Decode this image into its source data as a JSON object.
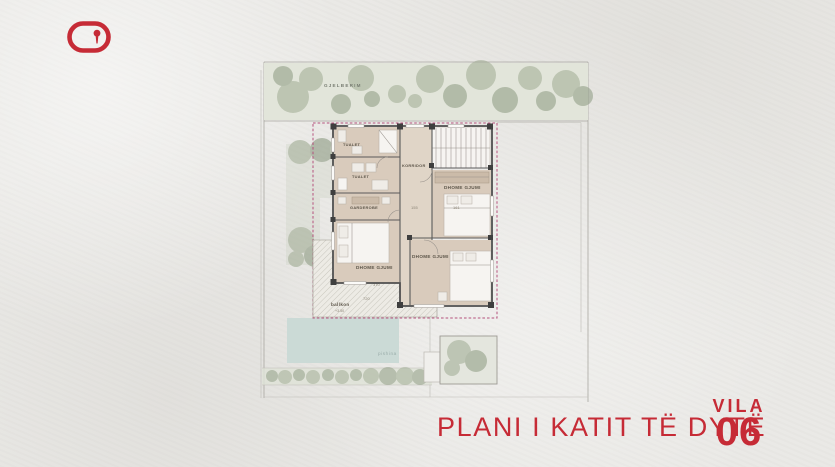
{
  "colors": {
    "accent_red": "#c62b36",
    "paper": "#e9e8e5",
    "room_beige": "#d9cbbc",
    "pool_blue": "#cbdad6",
    "greenery": "#9fab92",
    "boundary_dash": "#b5527d"
  },
  "header": {
    "logo_icon": "brand-pill-keyhole-logo"
  },
  "footer": {
    "plan_title": "PLANI I KATIT TË DYTË",
    "vila_label": "VILA",
    "vila_number": "06"
  },
  "plan": {
    "area_labels": {
      "greenery": "GJELBERIM",
      "toilet_1": "TUALET",
      "toilet_2": "TUALET",
      "wardrobe": "GARDEROBE",
      "corridor": "KORRIDOR",
      "bedroom_right": "DHOME GJUMI",
      "bedroom_left": "DHOME GJUMI",
      "bedroom_bottom": "DHOME GJUMI",
      "balcony": "ballkon",
      "balcony_level": "+3.50",
      "pool": "pishina"
    },
    "dimensions": {
      "corridor": "155",
      "bedroom_right": "161",
      "balcony_width": "370",
      "balcony_length": "720",
      "bedroom_bottom": "271"
    }
  }
}
